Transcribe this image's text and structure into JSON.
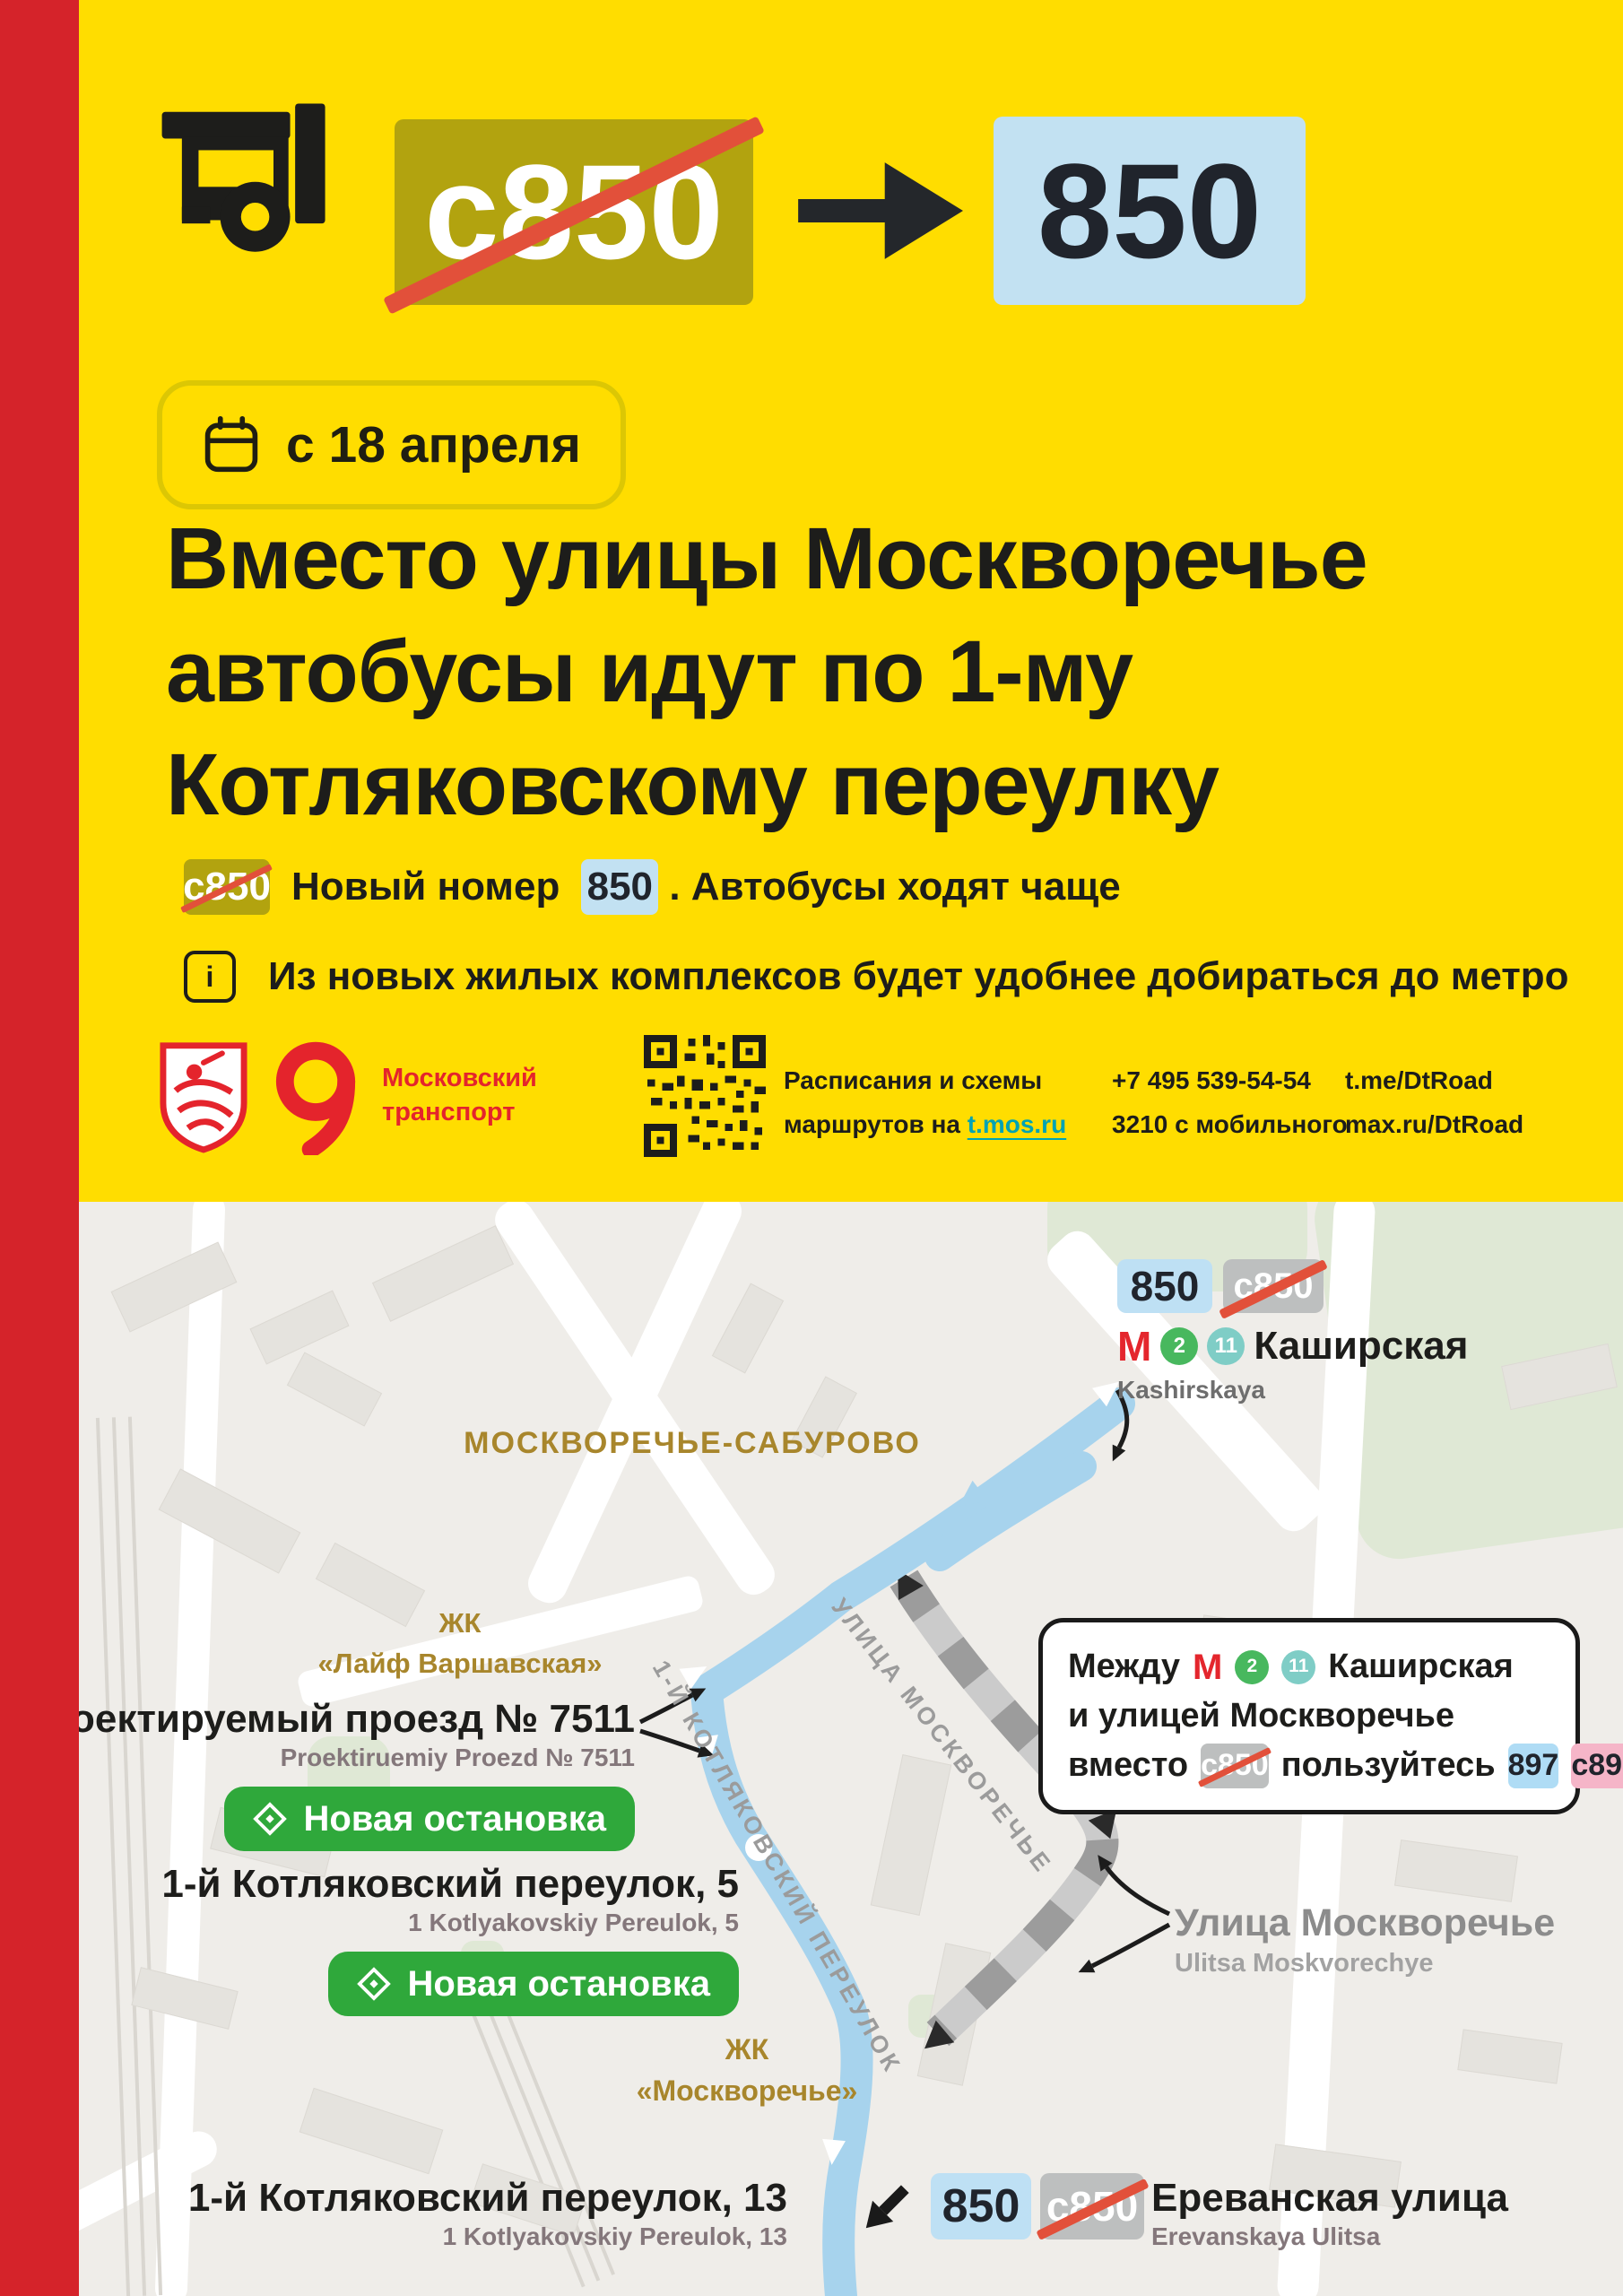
{
  "colors": {
    "yellow": "#FFDD00",
    "red_stripe": "#D5232A",
    "olive_badge": "#B2A30F",
    "light_blue_badge": "#C2E1F2",
    "strike_red": "#E2503A",
    "dark_text": "#1D1D1B",
    "brand_red": "#E4242C",
    "link_teal": "#00A3B4",
    "map_bg": "#EFEDE9",
    "route_blue": "#A7D3ED",
    "old_route_gray": "#9C9C9C",
    "gray_badge": "#BDBFBF",
    "pink_badge": "#F5B5C8",
    "green_pill": "#2FA83B",
    "gold_label": "#A8862C",
    "metro_red": "#E4262D",
    "line2_green": "#48B85E",
    "line11_teal": "#7FCDC6"
  },
  "header": {
    "old_route": "c850",
    "new_route": "850",
    "date": "с 18 апреля",
    "title_line1": "Вместо улицы Москворечье",
    "title_line2": "автобусы идут по 1-му",
    "title_line3": "Котляковскому переулку",
    "note1_old_badge": "c850",
    "note1_before": "Новый номер",
    "note1_new_badge": "850",
    "note1_after": ". Автобусы ходят чаще",
    "note2_icon_letter": "i",
    "note2": "Из новых жилых комплексов будет удобнее добираться до метро"
  },
  "footer": {
    "brand_line1": "Московский",
    "brand_line2": "транспорт",
    "qr_line1": "Расписания и схемы",
    "qr_line2_prefix": "маршрутов на ",
    "qr_link": "t.mos.ru",
    "phone_main": "+7 495 539-54-54",
    "phone_mobile": "3210 с мобильного",
    "telegram": "t.me/DtRoad",
    "max": "max.ru/DtRoad"
  },
  "map": {
    "district": "МОСКВОРЕЧЬЕ-САБУРОВО",
    "kashirskaya": {
      "new_badge": "850",
      "old_badge": "c850",
      "metro_letter": "М",
      "line2": "2",
      "line11": "11",
      "name": "Каширская",
      "name_latin": "Kashirskaya"
    },
    "zhk_life": {
      "line1": "ЖК",
      "line2": "«Лайф Варшавская»"
    },
    "stop_proezd": {
      "name": "Проектируемый проезд № 7511",
      "name_latin": "Proektiruemiy Proezd № 7511",
      "badge": "Новая остановка"
    },
    "stop_pereulok5": {
      "name": "1-й Котляковский переулок, 5",
      "name_latin": "1 Kotlyakovskiy Pereulok, 5",
      "badge": "Новая остановка"
    },
    "infobox": {
      "word1": "Между",
      "metro_letter": "М",
      "line2": "2",
      "line11": "11",
      "station": "Каширская",
      "row2": "и улицей Москворечье",
      "word2": "вместо",
      "old_badge": "c850",
      "word3": "пользуйтесь",
      "alt1": "897",
      "alt2": "c891"
    },
    "street_moskvorechye": {
      "name": "Улица Москворечье",
      "name_latin": "Ulitsa Moskvorechye"
    },
    "zhk_mosk": {
      "line1": "ЖК",
      "line2": "«Москворечье»"
    },
    "label_moskvorechye": "УЛИЦА МОСКВОРЕЧЬЕ",
    "label_kotlyakovsky": "1-Й КОТЛЯКОВСКИЙ ПЕРЕУЛОК",
    "terminus": {
      "name": "1-й Котляковский переулок, 13",
      "name_latin": "1 Kotlyakovskiy Pereulok, 13",
      "new_badge": "850",
      "old_badge": "c850",
      "street": "Ереванская улица",
      "street_latin": "Erevanskaya Ulitsa"
    }
  }
}
